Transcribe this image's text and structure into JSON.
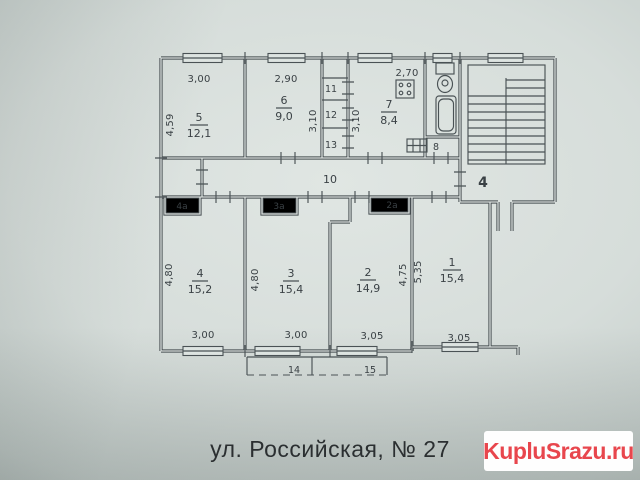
{
  "caption": {
    "text": "ул. Российская, № 27"
  },
  "watermark": {
    "text": "KupluSrazu.ru",
    "color": "#e8464d"
  },
  "plan": {
    "rooms": {
      "r5": {
        "num": "5",
        "area": "12,1"
      },
      "r6": {
        "num": "6",
        "area": "9,0"
      },
      "r7": {
        "num": "7",
        "area": "8,4"
      },
      "r4": {
        "num": "4",
        "area": "15,2"
      },
      "r3": {
        "num": "3",
        "area": "15,4"
      },
      "r2": {
        "num": "2",
        "area": "14,9"
      },
      "r1": {
        "num": "1",
        "area": "15,4"
      }
    },
    "labels": {
      "room11": "11",
      "room12": "12",
      "room13": "13",
      "room8": "8",
      "hall10": "10",
      "stairwell4": "4",
      "closet4a": "4а",
      "closet3a": "3а",
      "closet2a": "2а",
      "balcony14": "14",
      "balcony15": "15"
    },
    "dims": {
      "top5": "3,00",
      "top6": "2,90",
      "top7": "2,70",
      "left5": "4,59",
      "mid6": "3,10",
      "mid7": "3,10",
      "left4": "4,80",
      "left3": "4,80",
      "right2": "4,75",
      "left1": "5,35",
      "bot4": "3,00",
      "bot3": "3,00",
      "bot2": "3,05",
      "bot1": "3,05"
    }
  }
}
